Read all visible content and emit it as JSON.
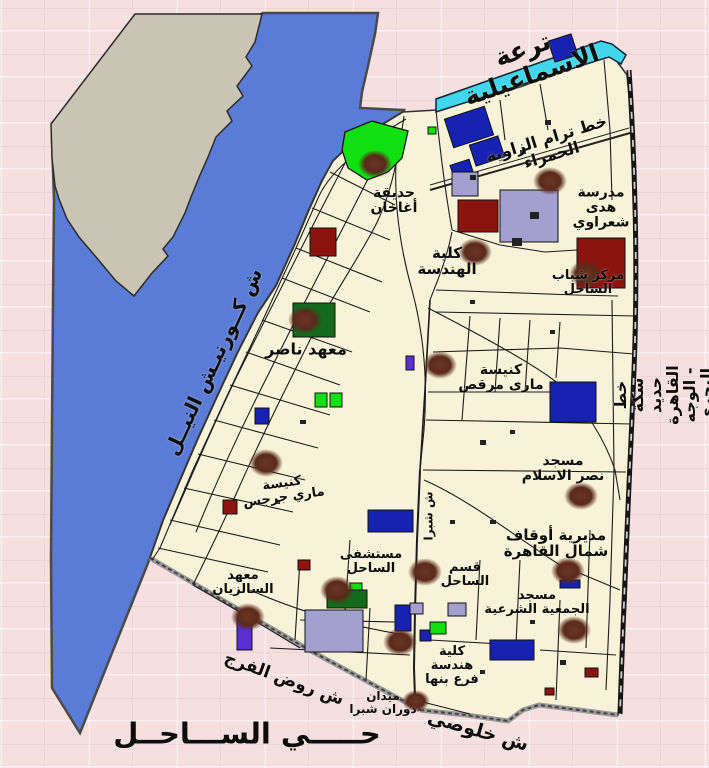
{
  "map": {
    "district_title": "حـــــي الســـاحــل",
    "colors": {
      "background_pink": "#f6dfdf",
      "river_blue": "#5b7cd6",
      "island_gray": "#c9c4b3",
      "canal_cyan": "#41d6ec",
      "district_cream": "#f8f3d8",
      "landmark_brown": "#5c2b1e",
      "building_navy": "#1822b0",
      "building_darkred": "#8a1410",
      "building_lavender": "#a3a0d0",
      "building_green": "#10e010",
      "building_darkgreen": "#14691c",
      "building_purple": "#5b2fd4"
    },
    "labels": [
      {
        "id": "canal-ismailia",
        "text": "ترعة الاسماعيلية",
        "x": 527,
        "y": 62,
        "rotate": -19,
        "size": 25
      },
      {
        "id": "tram-zawya-hamra",
        "text": "خط ترام الزاوية الحمراء",
        "x": 549,
        "y": 147,
        "rotate": -17,
        "size": 16
      },
      {
        "id": "school-hoda-shaarawy",
        "text": "مدرسة\nهدى\nشعراوي",
        "x": 601,
        "y": 208,
        "rotate": 0,
        "size": 14
      },
      {
        "id": "faculty-engineering",
        "text": "كلية\nالهندسة",
        "x": 447,
        "y": 261,
        "rotate": 0,
        "size": 15
      },
      {
        "id": "sahel-youth-center",
        "text": "مركز شباب\nالساحل",
        "x": 588,
        "y": 283,
        "rotate": 0,
        "size": 13
      },
      {
        "id": "aga-khan-garden",
        "text": "حديقة\nأغاخان",
        "x": 394,
        "y": 201,
        "rotate": 0,
        "size": 14
      },
      {
        "id": "nasser-institute",
        "text": "معهد ناصر",
        "x": 306,
        "y": 349,
        "rotate": 0,
        "size": 16
      },
      {
        "id": "church-mari-morcos",
        "text": "كنيسة\nماري مرقص",
        "x": 501,
        "y": 378,
        "rotate": 0,
        "size": 14
      },
      {
        "id": "mosque-nasr-islam",
        "text": "مسجد\nنصر الاسلام",
        "x": 563,
        "y": 469,
        "rotate": 0,
        "size": 14
      },
      {
        "id": "awqaf-north-cairo",
        "text": "مديرية أوقاف\nشمال القاهرة",
        "x": 556,
        "y": 543,
        "rotate": 0,
        "size": 15
      },
      {
        "id": "mosque-gamiya-sharia",
        "text": "مسجد\nالجمعية الشرعية",
        "x": 537,
        "y": 603,
        "rotate": 0,
        "size": 13
      },
      {
        "id": "sahel-police",
        "text": "قسم\nالساحل",
        "x": 465,
        "y": 575,
        "rotate": 0,
        "size": 13
      },
      {
        "id": "sahel-hospital",
        "text": "مستشفى\nالساحل",
        "x": 371,
        "y": 562,
        "rotate": 0,
        "size": 13
      },
      {
        "id": "church-mari-girgis",
        "text": "كنيسة\nماري جرجس",
        "x": 283,
        "y": 491,
        "rotate": -8,
        "size": 13
      },
      {
        "id": "salesian-institute",
        "text": "معهد\nالسالزيان",
        "x": 243,
        "y": 583,
        "rotate": 0,
        "size": 13
      },
      {
        "id": "faculty-engineering-benha",
        "text": "كلية\nهندسة\nفرع بنها",
        "x": 452,
        "y": 666,
        "rotate": 0,
        "size": 13
      },
      {
        "id": "midan-dawaran-shubra",
        "text": "ميدان\nدوران شبرا",
        "x": 383,
        "y": 703,
        "rotate": 0,
        "size": 12
      },
      {
        "id": "street-rod-el-farag",
        "text": "ش روض الفرج",
        "x": 284,
        "y": 679,
        "rotate": 20,
        "size": 17
      },
      {
        "id": "street-khulusi",
        "text": "ش خلوصي",
        "x": 478,
        "y": 731,
        "rotate": 16,
        "size": 19
      },
      {
        "id": "district-title",
        "text": "حـــــي الســـاحــل",
        "x": 247,
        "y": 734,
        "rotate": 0,
        "size": 29,
        "spacing": 2
      },
      {
        "id": "street-corniche-nile",
        "text": "ش كــورنيـش النيــل",
        "x": 214,
        "y": 362,
        "rotate": -65,
        "size": 20,
        "spacing": 2
      },
      {
        "id": "railway-cairo-delta",
        "text": "خط سكة حديد القاهرة - الوجه البحري",
        "x": 664,
        "y": 395,
        "rotate": -90,
        "size": 16
      },
      {
        "id": "street-shubra",
        "text": "ش شبرا",
        "x": 429,
        "y": 516,
        "rotate": -90,
        "size": 12
      }
    ],
    "landmarks": [
      {
        "name": "hoda-shaarawy-school",
        "cx": 550,
        "cy": 181
      },
      {
        "name": "faculty-engineering",
        "cx": 475,
        "cy": 252
      },
      {
        "name": "sahel-youth-center",
        "cx": 586,
        "cy": 274
      },
      {
        "name": "aga-khan-garden",
        "cx": 375,
        "cy": 164
      },
      {
        "name": "nasser-institute",
        "cx": 305,
        "cy": 320
      },
      {
        "name": "mari-morcos-church",
        "cx": 440,
        "cy": 365
      },
      {
        "name": "mari-girgis-church",
        "cx": 266,
        "cy": 463
      },
      {
        "name": "nasr-islam-mosque",
        "cx": 581,
        "cy": 496
      },
      {
        "name": "awqaf-directorate",
        "cx": 568,
        "cy": 571
      },
      {
        "name": "gamiya-sharia-mosque",
        "cx": 574,
        "cy": 630
      },
      {
        "name": "sahel-police-station",
        "cx": 425,
        "cy": 572
      },
      {
        "name": "sahel-hospital",
        "cx": 337,
        "cy": 590
      },
      {
        "name": "salesian-institute",
        "cx": 248,
        "cy": 617
      },
      {
        "name": "benha-engineering-faculty",
        "cx": 400,
        "cy": 642
      },
      {
        "name": "shubra-roundabout",
        "cx": 416,
        "cy": 701,
        "rx": 14,
        "ry": 11
      }
    ]
  }
}
